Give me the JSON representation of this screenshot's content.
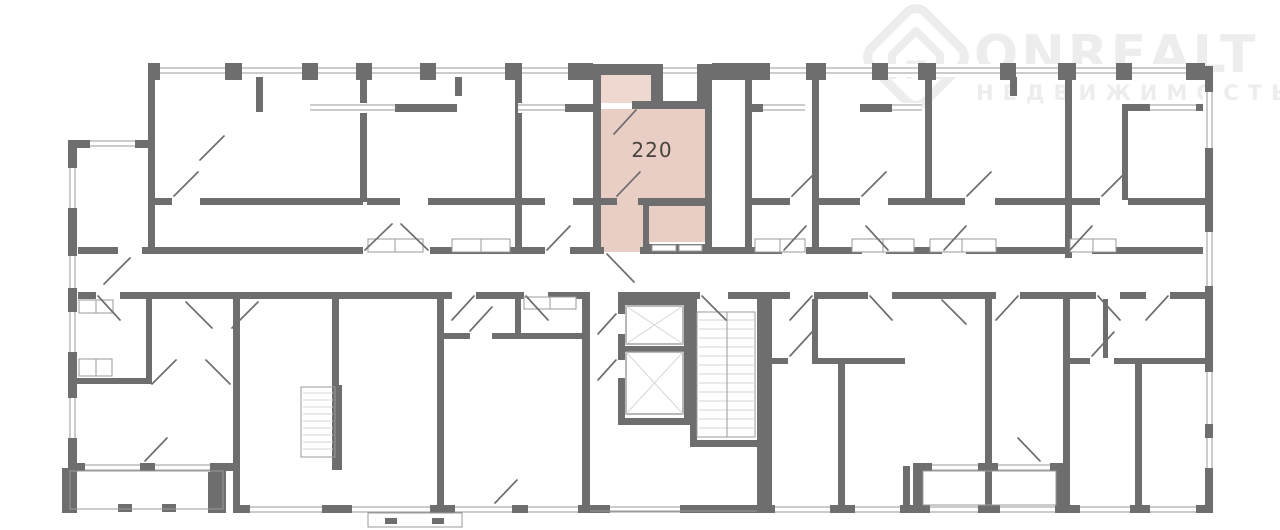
{
  "watermark": {
    "brand": "ONREALT",
    "subtitle": "НЕДВИЖИМОСТЬ",
    "icon": "house-in-diamond"
  },
  "floorplan": {
    "highlighted_unit": {
      "label": "220"
    }
  },
  "colors": {
    "wall": "#6e6e6e",
    "thin": "#9a9a9a",
    "stair": "#d6d6d6",
    "unit-fill": "#e8cec5",
    "unit-balcony-fill": "#eed8cf",
    "unit-label": "#4a423c",
    "watermark": "#ededed"
  }
}
